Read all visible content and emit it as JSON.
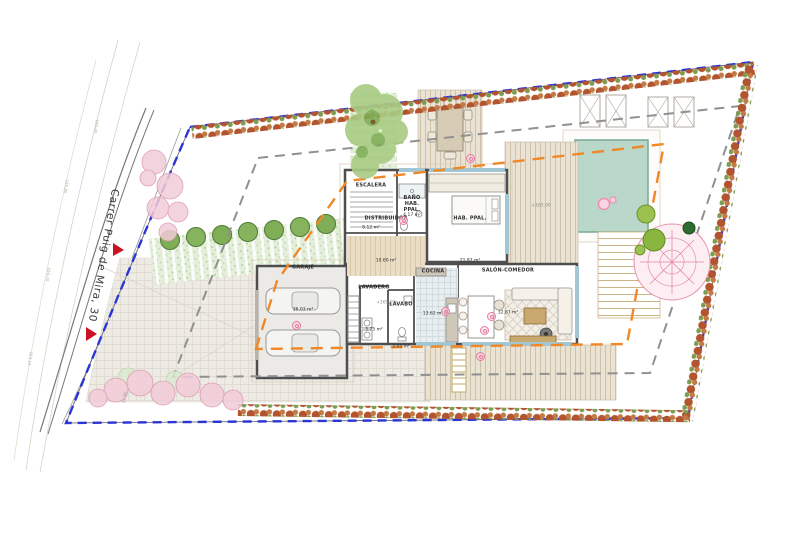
{
  "site": {
    "street_label": "Carrer Puig de Mira, 30",
    "boundary_dimension": "39.75",
    "contour_labels": [
      "166.40",
      "165.80",
      "164.20",
      "163.15"
    ]
  },
  "levels": {
    "ground_hall": "+165.20",
    "terrace": "+165.00"
  },
  "rooms": {
    "escalera": {
      "name": "ESCALERA",
      "area": "8.12 m²"
    },
    "bano_hab_ppal": {
      "name": "BAÑO HAB. PPAL.",
      "area": "4.17 m²"
    },
    "hab_ppal": {
      "name": "HAB. PPAL.",
      "area": "21.87 m²"
    },
    "distribuidor": {
      "name": "DISTRIBUIDOR",
      "area": "10.60 m²"
    },
    "garaje": {
      "name": "GARAJE",
      "area": "36.03 m²"
    },
    "lavadero": {
      "name": "LAVADERO",
      "area": "3.75 m²"
    },
    "lavabo": {
      "name": "LAVABO",
      "area": "3.05 m²"
    },
    "cocina": {
      "name": "COCINA",
      "area": "13.62 m²"
    },
    "salon_comedor": {
      "name": "SALÓN-COMEDOR",
      "area": "32.87 m²"
    }
  },
  "colors": {
    "boundary_blue": "#2a35d4",
    "envelope_orange": "#f08828",
    "setback_gray": "#909090",
    "pool_water": "#b9d8ca",
    "hedge_red": "#b2552f",
    "hedge_green": "#7d9c50",
    "wall": "#4e4e4e",
    "tag_pink": "#e878a2",
    "entry_red": "#cc1122"
  }
}
